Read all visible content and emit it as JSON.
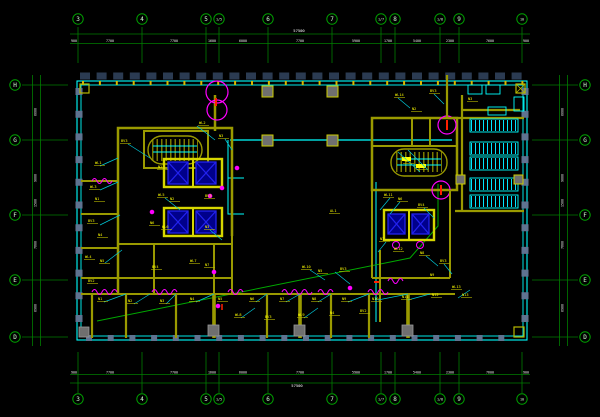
{
  "colors": {
    "background": "#000000",
    "axis_green": "#00a000",
    "wall_cyan": "#00ffff",
    "wall_olive": "#9a9a00",
    "shaft_yellow": "#d6d600",
    "elevator_navy": "#00008b",
    "annotation_magenta": "#ff00ff",
    "tag_yellow": "#ffff00",
    "dim_white": "#ffffff",
    "column_gray": "#5f7390",
    "band_navy": "#2b3b52",
    "cable_green": "#00aa00",
    "alert_red": "#ff2000"
  },
  "axes": {
    "top": {
      "items": [
        {
          "label": "3",
          "x": 78
        },
        {
          "label": "4",
          "x": 142
        },
        {
          "label": "5",
          "x": 206
        },
        {
          "label": "1/5",
          "x": 219
        },
        {
          "label": "6",
          "x": 268
        },
        {
          "label": "7",
          "x": 332
        },
        {
          "label": "1/7",
          "x": 381
        },
        {
          "label": "8",
          "x": 395
        },
        {
          "label": "1/8",
          "x": 440
        },
        {
          "label": "9",
          "x": 459
        },
        {
          "label": "10",
          "x": 522
        }
      ]
    },
    "bottom": {
      "items": [
        {
          "label": "3",
          "x": 78
        },
        {
          "label": "4",
          "x": 142
        },
        {
          "label": "5",
          "x": 206
        },
        {
          "label": "1/5",
          "x": 219
        },
        {
          "label": "6",
          "x": 268
        },
        {
          "label": "7",
          "x": 332
        },
        {
          "label": "1/7",
          "x": 381
        },
        {
          "label": "8",
          "x": 395
        },
        {
          "label": "1/8",
          "x": 440
        },
        {
          "label": "9",
          "x": 459
        },
        {
          "label": "10",
          "x": 522
        }
      ]
    },
    "left": {
      "items": [
        {
          "label": "H",
          "y": 85
        },
        {
          "label": "G",
          "y": 140
        },
        {
          "label": "F",
          "y": 215
        },
        {
          "label": "E",
          "y": 280
        },
        {
          "label": "D",
          "y": 337
        }
      ]
    },
    "right": {
      "items": [
        {
          "label": "H",
          "y": 85
        },
        {
          "label": "G",
          "y": 140
        },
        {
          "label": "F",
          "y": 215
        },
        {
          "label": "E",
          "y": 280
        },
        {
          "label": "D",
          "y": 337
        }
      ]
    }
  },
  "dims": {
    "top": {
      "total": {
        "text": "57500",
        "x": 299,
        "y": 32
      },
      "segments": [
        {
          "text": "900",
          "x": 74
        },
        {
          "text": "7700",
          "x": 110
        },
        {
          "text": "7700",
          "x": 174
        },
        {
          "text": "1600",
          "x": 212
        },
        {
          "text": "6000",
          "x": 243
        },
        {
          "text": "7700",
          "x": 300
        },
        {
          "text": "5900",
          "x": 356
        },
        {
          "text": "1700",
          "x": 388
        },
        {
          "text": "5400",
          "x": 417
        },
        {
          "text": "2300",
          "x": 450
        },
        {
          "text": "7600",
          "x": 490
        },
        {
          "text": "900",
          "x": 526
        }
      ]
    },
    "bottom": {
      "total": {
        "text": "57500",
        "x": 297,
        "y": 387
      },
      "segments": [
        {
          "text": "900",
          "x": 74
        },
        {
          "text": "7700",
          "x": 110
        },
        {
          "text": "7700",
          "x": 174
        },
        {
          "text": "1600",
          "x": 212
        },
        {
          "text": "6000",
          "x": 243
        },
        {
          "text": "7700",
          "x": 300
        },
        {
          "text": "5900",
          "x": 356
        },
        {
          "text": "1700",
          "x": 388
        },
        {
          "text": "5400",
          "x": 417
        },
        {
          "text": "2300",
          "x": 450
        },
        {
          "text": "7600",
          "x": 490
        },
        {
          "text": "900",
          "x": 526
        }
      ]
    },
    "left": {
      "segments": [
        {
          "text": "6600",
          "y": 112
        },
        {
          "text": "9000",
          "y": 178
        },
        {
          "text": "1500",
          "y": 203
        },
        {
          "text": "7800",
          "y": 245
        },
        {
          "text": "6900",
          "y": 308
        }
      ]
    },
    "right": {
      "segments": [
        {
          "text": "6600",
          "y": 112
        },
        {
          "text": "9000",
          "y": 178
        },
        {
          "text": "1500",
          "y": 203
        },
        {
          "text": "7800",
          "y": 245
        },
        {
          "text": "6900",
          "y": 308
        }
      ]
    }
  },
  "tags": [
    {
      "x": 95,
      "y": 164,
      "t": "WL1"
    },
    {
      "x": 121,
      "y": 142,
      "t": "BV3"
    },
    {
      "x": 158,
      "y": 168,
      "t": "N2"
    },
    {
      "x": 199,
      "y": 124,
      "t": "WL2"
    },
    {
      "x": 219,
      "y": 137,
      "t": "N3"
    },
    {
      "x": 90,
      "y": 188,
      "t": "WL3"
    },
    {
      "x": 95,
      "y": 200,
      "t": "N1"
    },
    {
      "x": 88,
      "y": 222,
      "t": "BV3"
    },
    {
      "x": 98,
      "y": 236,
      "t": "N4"
    },
    {
      "x": 85,
      "y": 258,
      "t": "WL4"
    },
    {
      "x": 100,
      "y": 262,
      "t": "N5"
    },
    {
      "x": 88,
      "y": 282,
      "t": "BV2"
    },
    {
      "x": 158,
      "y": 196,
      "t": "WL5"
    },
    {
      "x": 170,
      "y": 200,
      "t": "N2"
    },
    {
      "x": 205,
      "y": 197,
      "t": "BV3"
    },
    {
      "x": 150,
      "y": 224,
      "t": "N6"
    },
    {
      "x": 162,
      "y": 228,
      "t": "WL6"
    },
    {
      "x": 205,
      "y": 228,
      "t": "N3"
    },
    {
      "x": 190,
      "y": 262,
      "t": "WL7"
    },
    {
      "x": 205,
      "y": 266,
      "t": "N7"
    },
    {
      "x": 152,
      "y": 268,
      "t": "BV4"
    },
    {
      "x": 98,
      "y": 300,
      "t": "N1"
    },
    {
      "x": 128,
      "y": 302,
      "t": "N2"
    },
    {
      "x": 160,
      "y": 302,
      "t": "N3"
    },
    {
      "x": 190,
      "y": 300,
      "t": "N4"
    },
    {
      "x": 218,
      "y": 300,
      "t": "N5"
    },
    {
      "x": 250,
      "y": 300,
      "t": "N6"
    },
    {
      "x": 280,
      "y": 300,
      "t": "N7"
    },
    {
      "x": 312,
      "y": 300,
      "t": "N8"
    },
    {
      "x": 342,
      "y": 300,
      "t": "N9"
    },
    {
      "x": 372,
      "y": 300,
      "t": "N10"
    },
    {
      "x": 402,
      "y": 298,
      "t": "N11"
    },
    {
      "x": 432,
      "y": 296,
      "t": "N12"
    },
    {
      "x": 462,
      "y": 296,
      "t": "N13"
    },
    {
      "x": 235,
      "y": 316,
      "t": "WL8"
    },
    {
      "x": 265,
      "y": 318,
      "t": "BV3"
    },
    {
      "x": 298,
      "y": 316,
      "t": "WL9"
    },
    {
      "x": 330,
      "y": 314,
      "t": "N4"
    },
    {
      "x": 360,
      "y": 312,
      "t": "BV2"
    },
    {
      "x": 302,
      "y": 268,
      "t": "WL10"
    },
    {
      "x": 318,
      "y": 272,
      "t": "N5"
    },
    {
      "x": 340,
      "y": 270,
      "t": "BV3"
    },
    {
      "x": 384,
      "y": 196,
      "t": "WL11"
    },
    {
      "x": 398,
      "y": 200,
      "t": "N6"
    },
    {
      "x": 418,
      "y": 206,
      "t": "BV4"
    },
    {
      "x": 380,
      "y": 240,
      "t": "N7"
    },
    {
      "x": 394,
      "y": 250,
      "t": "WL12"
    },
    {
      "x": 420,
      "y": 254,
      "t": "N8"
    },
    {
      "x": 440,
      "y": 262,
      "t": "BV3"
    },
    {
      "x": 430,
      "y": 276,
      "t": "N9"
    },
    {
      "x": 452,
      "y": 288,
      "t": "WL13"
    },
    {
      "x": 395,
      "y": 96,
      "t": "WL14"
    },
    {
      "x": 412,
      "y": 110,
      "t": "N2"
    },
    {
      "x": 430,
      "y": 92,
      "t": "BV3"
    },
    {
      "x": 468,
      "y": 100,
      "t": "N3"
    },
    {
      "x": 330,
      "y": 212,
      "t": "AL1"
    },
    {
      "x": 404,
      "y": 162,
      "t": "TD"
    },
    {
      "x": 417,
      "y": 168,
      "t": "N1"
    }
  ]
}
